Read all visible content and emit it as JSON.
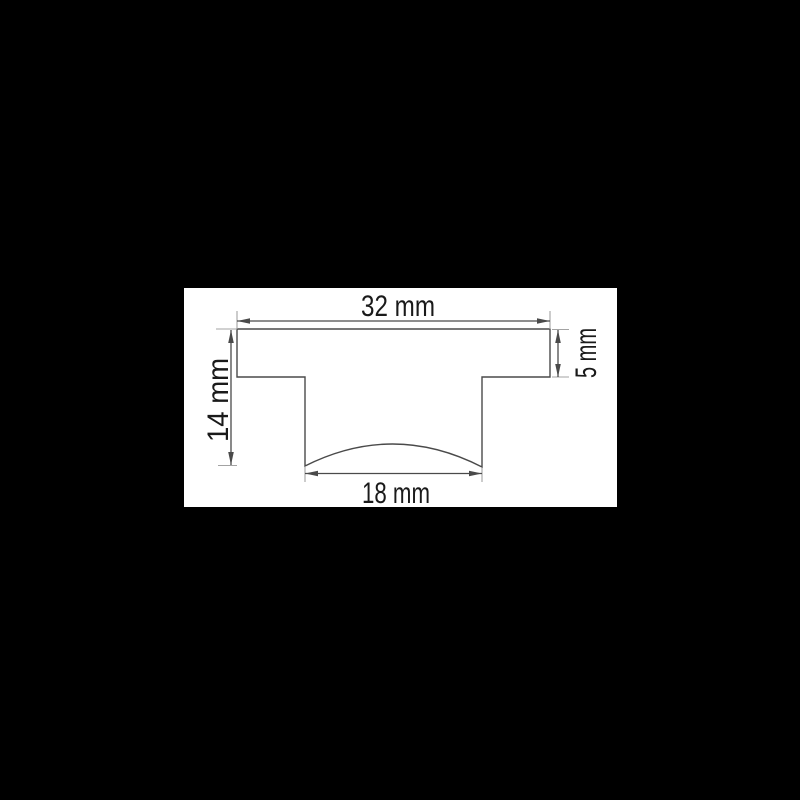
{
  "canvas": {
    "background_color": "#000000",
    "panel_color": "#ffffff"
  },
  "diagram": {
    "type": "technical-drawing",
    "shape": "t-profile-cross-section",
    "line_color": "#4a4a4a",
    "extension_line_color": "#a3a3a3",
    "text_color": "#1a1a1a",
    "dimensions": {
      "top": {
        "label": "32 mm",
        "value_mm": 32,
        "orientation": "horizontal"
      },
      "right": {
        "label": "5 mm",
        "value_mm": 5,
        "orientation": "vertical"
      },
      "left": {
        "label": "14 mm",
        "value_mm": 14,
        "orientation": "vertical"
      },
      "bottom": {
        "label": "18 mm",
        "value_mm": 18,
        "orientation": "horizontal"
      }
    }
  }
}
